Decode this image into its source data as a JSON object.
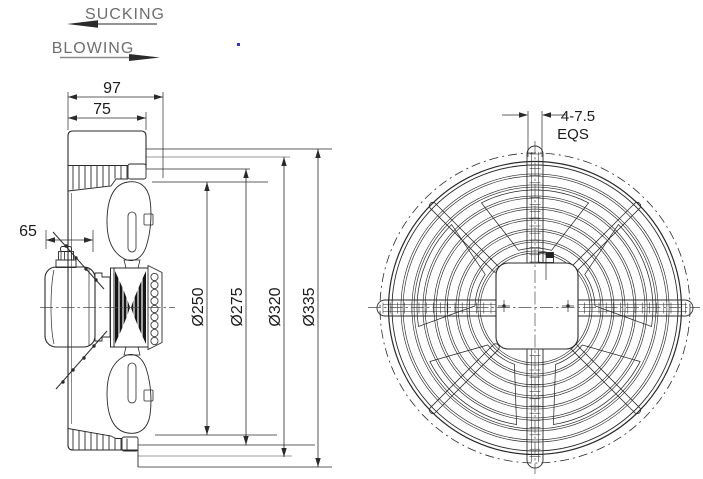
{
  "labels": {
    "sucking": "SUCKING",
    "blowing": "BLOWING"
  },
  "side_view": {
    "depth_overall": "97",
    "depth_bellmouth": "75",
    "motor_depth": "65",
    "blade_diameter": "Ø250",
    "throat_diameter": "Ø275",
    "bolt_circle_diameter": "Ø320",
    "overall_diameter": "Ø335"
  },
  "front_view": {
    "clip_width": "4-7.5",
    "clip_spacing": "EQS"
  },
  "colors": {
    "line": "#2a2a2a",
    "light_line": "#9a9a9a",
    "flow_text": "#6e6e6e",
    "background": "#ffffff",
    "artifact_dot": "#3535cc"
  }
}
